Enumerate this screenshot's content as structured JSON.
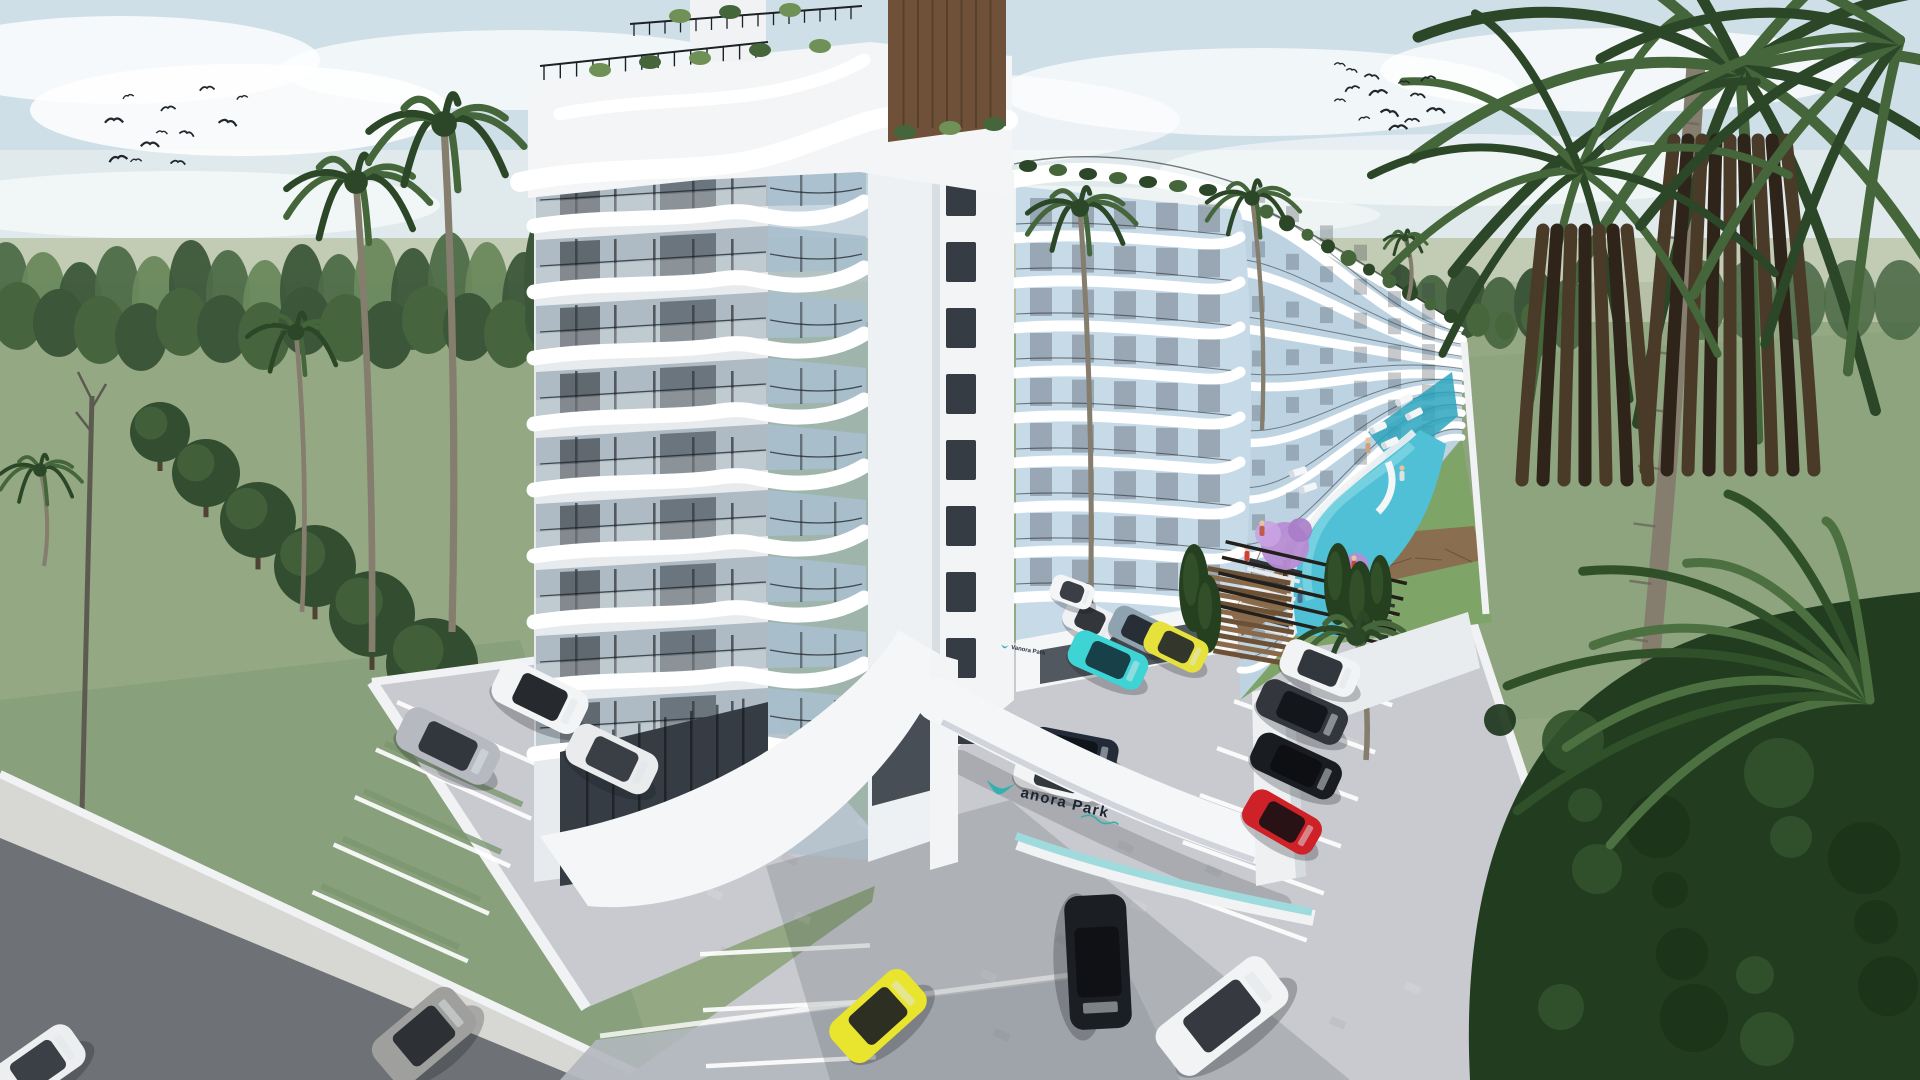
{
  "scene": {
    "type": "3d-architectural-rendering",
    "subject": "Aerial exterior view of Vanora Park residential resort complex with pool, palm trees and parking",
    "sign": {
      "brand_initial": "V",
      "brand_text": "anora Park",
      "full_name": "Vanora Park"
    }
  },
  "colors": {
    "sky_top": "#cfdfe8",
    "sky_mid": "#e3ecec",
    "cloud": "#ffffff",
    "field": "#b6c0a7",
    "field_far": "#c2cbb3",
    "grass": "#93a883",
    "grass_dark": "#7c9670",
    "forest_dark": "#3c5639",
    "forest_mid": "#4e6b48",
    "forest_light": "#69885c",
    "tree_dark": "#324d2f",
    "tree_light": "#47663c",
    "palm_trunk": "#857d6e",
    "palm_dark": "#2b4727",
    "palm_mid": "#44663a",
    "palm_light": "#6f9156",
    "skirt_dark": "#2e241a",
    "skirt_mid": "#4a3a28",
    "building": "#f4f6f7",
    "slab": "#ffffff",
    "facade_shade": "#dde2e6",
    "glass_dark": "#353c44",
    "glass_mid": "#aebbc4",
    "glass_blue": "#a9bfcd",
    "glass_pale": "#c7dae8",
    "glass_sky": "#bdd3e2",
    "railing": "#1c2126",
    "wood": "#6e5138",
    "wood_dark": "#4e3827",
    "pool": "#4fc0d5",
    "pool_deep": "#2da4bd",
    "pool_light": "#8fdbe8",
    "deck": "#8a6e50",
    "purple": "#b78cd4",
    "road": "#6e7277",
    "sidewalk": "#d7d8d3",
    "paver": "#c8cacf",
    "paver_dark": "#b3b7be",
    "wall": "#f1f2f4",
    "shadow": "#2b3239",
    "teal": "#35b1ad",
    "teal_light": "#9fdbdd",
    "sign_text": "#1b2430",
    "bird": "#20262b"
  },
  "sky": {
    "birds_left": [
      [
        128,
        96
      ],
      [
        168,
        108
      ],
      [
        114,
        120
      ],
      [
        162,
        132
      ],
      [
        187,
        133
      ],
      [
        118,
        158
      ],
      [
        136,
        160
      ],
      [
        178,
        162
      ],
      [
        228,
        122
      ],
      [
        242,
        97
      ],
      [
        207,
        88
      ],
      [
        150,
        144
      ]
    ],
    "birds_right": [
      [
        1340,
        64
      ],
      [
        1352,
        88
      ],
      [
        1378,
        92
      ],
      [
        1404,
        82
      ],
      [
        1418,
        95
      ],
      [
        1390,
        112
      ],
      [
        1364,
        118
      ],
      [
        1412,
        120
      ],
      [
        1436,
        110
      ],
      [
        1352,
        70
      ],
      [
        1428,
        78
      ],
      [
        1398,
        127
      ],
      [
        1340,
        100
      ],
      [
        1372,
        76
      ]
    ]
  },
  "buildings": {
    "front_tower": {
      "floors": 9
    },
    "second_tower": {
      "floors": 9
    },
    "rear_wing": {
      "bands": 9,
      "roof_planters": 11
    }
  },
  "pool": {
    "people": [
      {
        "x": 1262,
        "y": 531,
        "c": "#c05a4a"
      },
      {
        "x": 1247,
        "y": 556,
        "c": "#d2402f"
      },
      {
        "x": 1300,
        "y": 598,
        "c": "#4a6a8a"
      },
      {
        "x": 1354,
        "y": 566,
        "c": "#d2402f"
      },
      {
        "x": 1402,
        "y": 476,
        "c": "#e0e2e4"
      },
      {
        "x": 1368,
        "y": 448,
        "c": "#caa27e"
      }
    ],
    "loungers": [
      {
        "x": 1378,
        "y": 428,
        "r": -25
      },
      {
        "x": 1390,
        "y": 443,
        "r": -25
      },
      {
        "x": 1404,
        "y": 400,
        "r": -27
      },
      {
        "x": 1414,
        "y": 414,
        "r": -27
      },
      {
        "x": 1298,
        "y": 472,
        "r": -18
      },
      {
        "x": 1308,
        "y": 488,
        "r": -18
      }
    ]
  },
  "landscape": {
    "trees_row": [
      {
        "x": 160,
        "y": 432,
        "r": 30
      },
      {
        "x": 206,
        "y": 473,
        "r": 34
      },
      {
        "x": 258,
        "y": 520,
        "r": 38
      },
      {
        "x": 315,
        "y": 566,
        "r": 41
      },
      {
        "x": 372,
        "y": 614,
        "r": 43
      },
      {
        "x": 432,
        "y": 664,
        "r": 46
      },
      {
        "x": 492,
        "y": 714,
        "r": 48
      }
    ],
    "cypresses": [
      {
        "x": 1194,
        "y": 588,
        "h": 88
      },
      {
        "x": 1208,
        "y": 614,
        "h": 78
      },
      {
        "x": 1338,
        "y": 584,
        "h": 82
      },
      {
        "x": 1360,
        "y": 604,
        "h": 86
      },
      {
        "x": 1380,
        "y": 590,
        "h": 70
      }
    ],
    "palms": [
      {
        "type": "crown",
        "bx": 372,
        "by": 652,
        "tx": 356,
        "ty": 182,
        "r": 74
      },
      {
        "type": "crown",
        "bx": 452,
        "by": 632,
        "tx": 444,
        "ty": 124,
        "r": 80
      },
      {
        "type": "crown",
        "bx": 302,
        "by": 612,
        "tx": 296,
        "ty": 332,
        "r": 52
      },
      {
        "type": "crown",
        "bx": 44,
        "by": 566,
        "tx": 40,
        "ty": 470,
        "r": 42
      },
      {
        "type": "crown",
        "bx": 1090,
        "by": 636,
        "tx": 1080,
        "ty": 208,
        "r": 56
      },
      {
        "type": "crown",
        "bx": 1262,
        "by": 430,
        "tx": 1252,
        "ty": 198,
        "r": 48
      },
      {
        "type": "crown",
        "bx": 1408,
        "by": 300,
        "tx": 1405,
        "ty": 238,
        "r": 22
      },
      {
        "type": "crown",
        "bx": 1366,
        "by": 760,
        "tx": 1356,
        "ty": 636,
        "r": 62
      }
    ]
  },
  "vehicles": [
    {
      "name": "white-suv",
      "x": 540,
      "y": 697,
      "w": 96,
      "h": 46,
      "rot": 26,
      "color": "#f2f4f6",
      "cab": "#15181c"
    },
    {
      "name": "silver-sedan",
      "x": 448,
      "y": 746,
      "w": 104,
      "h": 46,
      "rot": 26,
      "color": "#b6bac0",
      "cab": "#262b31"
    },
    {
      "name": "white-hatchback",
      "x": 612,
      "y": 759,
      "w": 92,
      "h": 44,
      "rot": 26,
      "color": "#e9ebed",
      "cab": "#2a2f36"
    },
    {
      "name": "white-minicar",
      "x": 1090,
      "y": 620,
      "w": 54,
      "h": 32,
      "rot": 26,
      "color": "#eff1f3",
      "cab": "#23272d"
    },
    {
      "name": "slate-blue-car",
      "x": 1138,
      "y": 630,
      "w": 58,
      "h": 34,
      "rot": 26,
      "color": "#8fa2b0",
      "cab": "#1f242b"
    },
    {
      "name": "cyan-sports-car",
      "x": 1108,
      "y": 660,
      "w": 80,
      "h": 38,
      "rot": 24,
      "color": "#3ed3d4",
      "cab": "#14333c"
    },
    {
      "name": "yellow-sports-car",
      "x": 1176,
      "y": 647,
      "w": 64,
      "h": 34,
      "rot": 26,
      "color": "#e6e23b",
      "cab": "#23272a"
    },
    {
      "name": "navy-coupe",
      "x": 1074,
      "y": 751,
      "w": 88,
      "h": 36,
      "rot": 11,
      "color": "#232b38",
      "cab": "#0e1319",
      "layer": "back"
    },
    {
      "name": "white-convertible",
      "x": 1058,
      "y": 776,
      "w": 88,
      "h": 38,
      "rot": 13,
      "color": "#f3f4f6",
      "cab": "#23272d",
      "layer": "back"
    },
    {
      "name": "white-car",
      "x": 1320,
      "y": 668,
      "w": 80,
      "h": 38,
      "rot": 22,
      "color": "#f1f3f5",
      "cab": "#22262c"
    },
    {
      "name": "graphite-sedan",
      "x": 1302,
      "y": 712,
      "w": 92,
      "h": 40,
      "rot": 24,
      "color": "#33373d",
      "cab": "#101318"
    },
    {
      "name": "black-coupe",
      "x": 1296,
      "y": 766,
      "w": 92,
      "h": 40,
      "rot": 25,
      "color": "#191c20",
      "cab": "#0c0e12"
    },
    {
      "name": "red-car",
      "x": 1282,
      "y": 822,
      "w": 80,
      "h": 40,
      "rot": 30,
      "color": "#cf2128",
      "cab": "#1a1115"
    },
    {
      "name": "yellow-supercar",
      "x": 878,
      "y": 1016,
      "w": 100,
      "h": 52,
      "rot": -42,
      "color": "#e9e42e",
      "cab": "#1d2023"
    },
    {
      "name": "black-suv",
      "x": 1098,
      "y": 962,
      "w": 134,
      "h": 62,
      "rot": 87,
      "color": "#1b1e23",
      "cab": "#0e1013"
    },
    {
      "name": "white-suv-2",
      "x": 1222,
      "y": 1016,
      "w": 136,
      "h": 60,
      "rot": -38,
      "color": "#f2f3f5",
      "cab": "#262a30"
    },
    {
      "name": "gray-minivan",
      "x": 424,
      "y": 1036,
      "w": 104,
      "h": 56,
      "rot": -40,
      "color": "#9fa09d",
      "cab": "#23262b"
    },
    {
      "name": "white-car-corner",
      "x": 38,
      "y": 1066,
      "w": 96,
      "h": 48,
      "rot": -35,
      "color": "#eceef0",
      "cab": "#2b3037"
    },
    {
      "name": "white-van",
      "x": 1072,
      "y": 592,
      "w": 44,
      "h": 26,
      "rot": 20,
      "color": "#f4f5f7",
      "cab": "#2a2f35"
    }
  ]
}
